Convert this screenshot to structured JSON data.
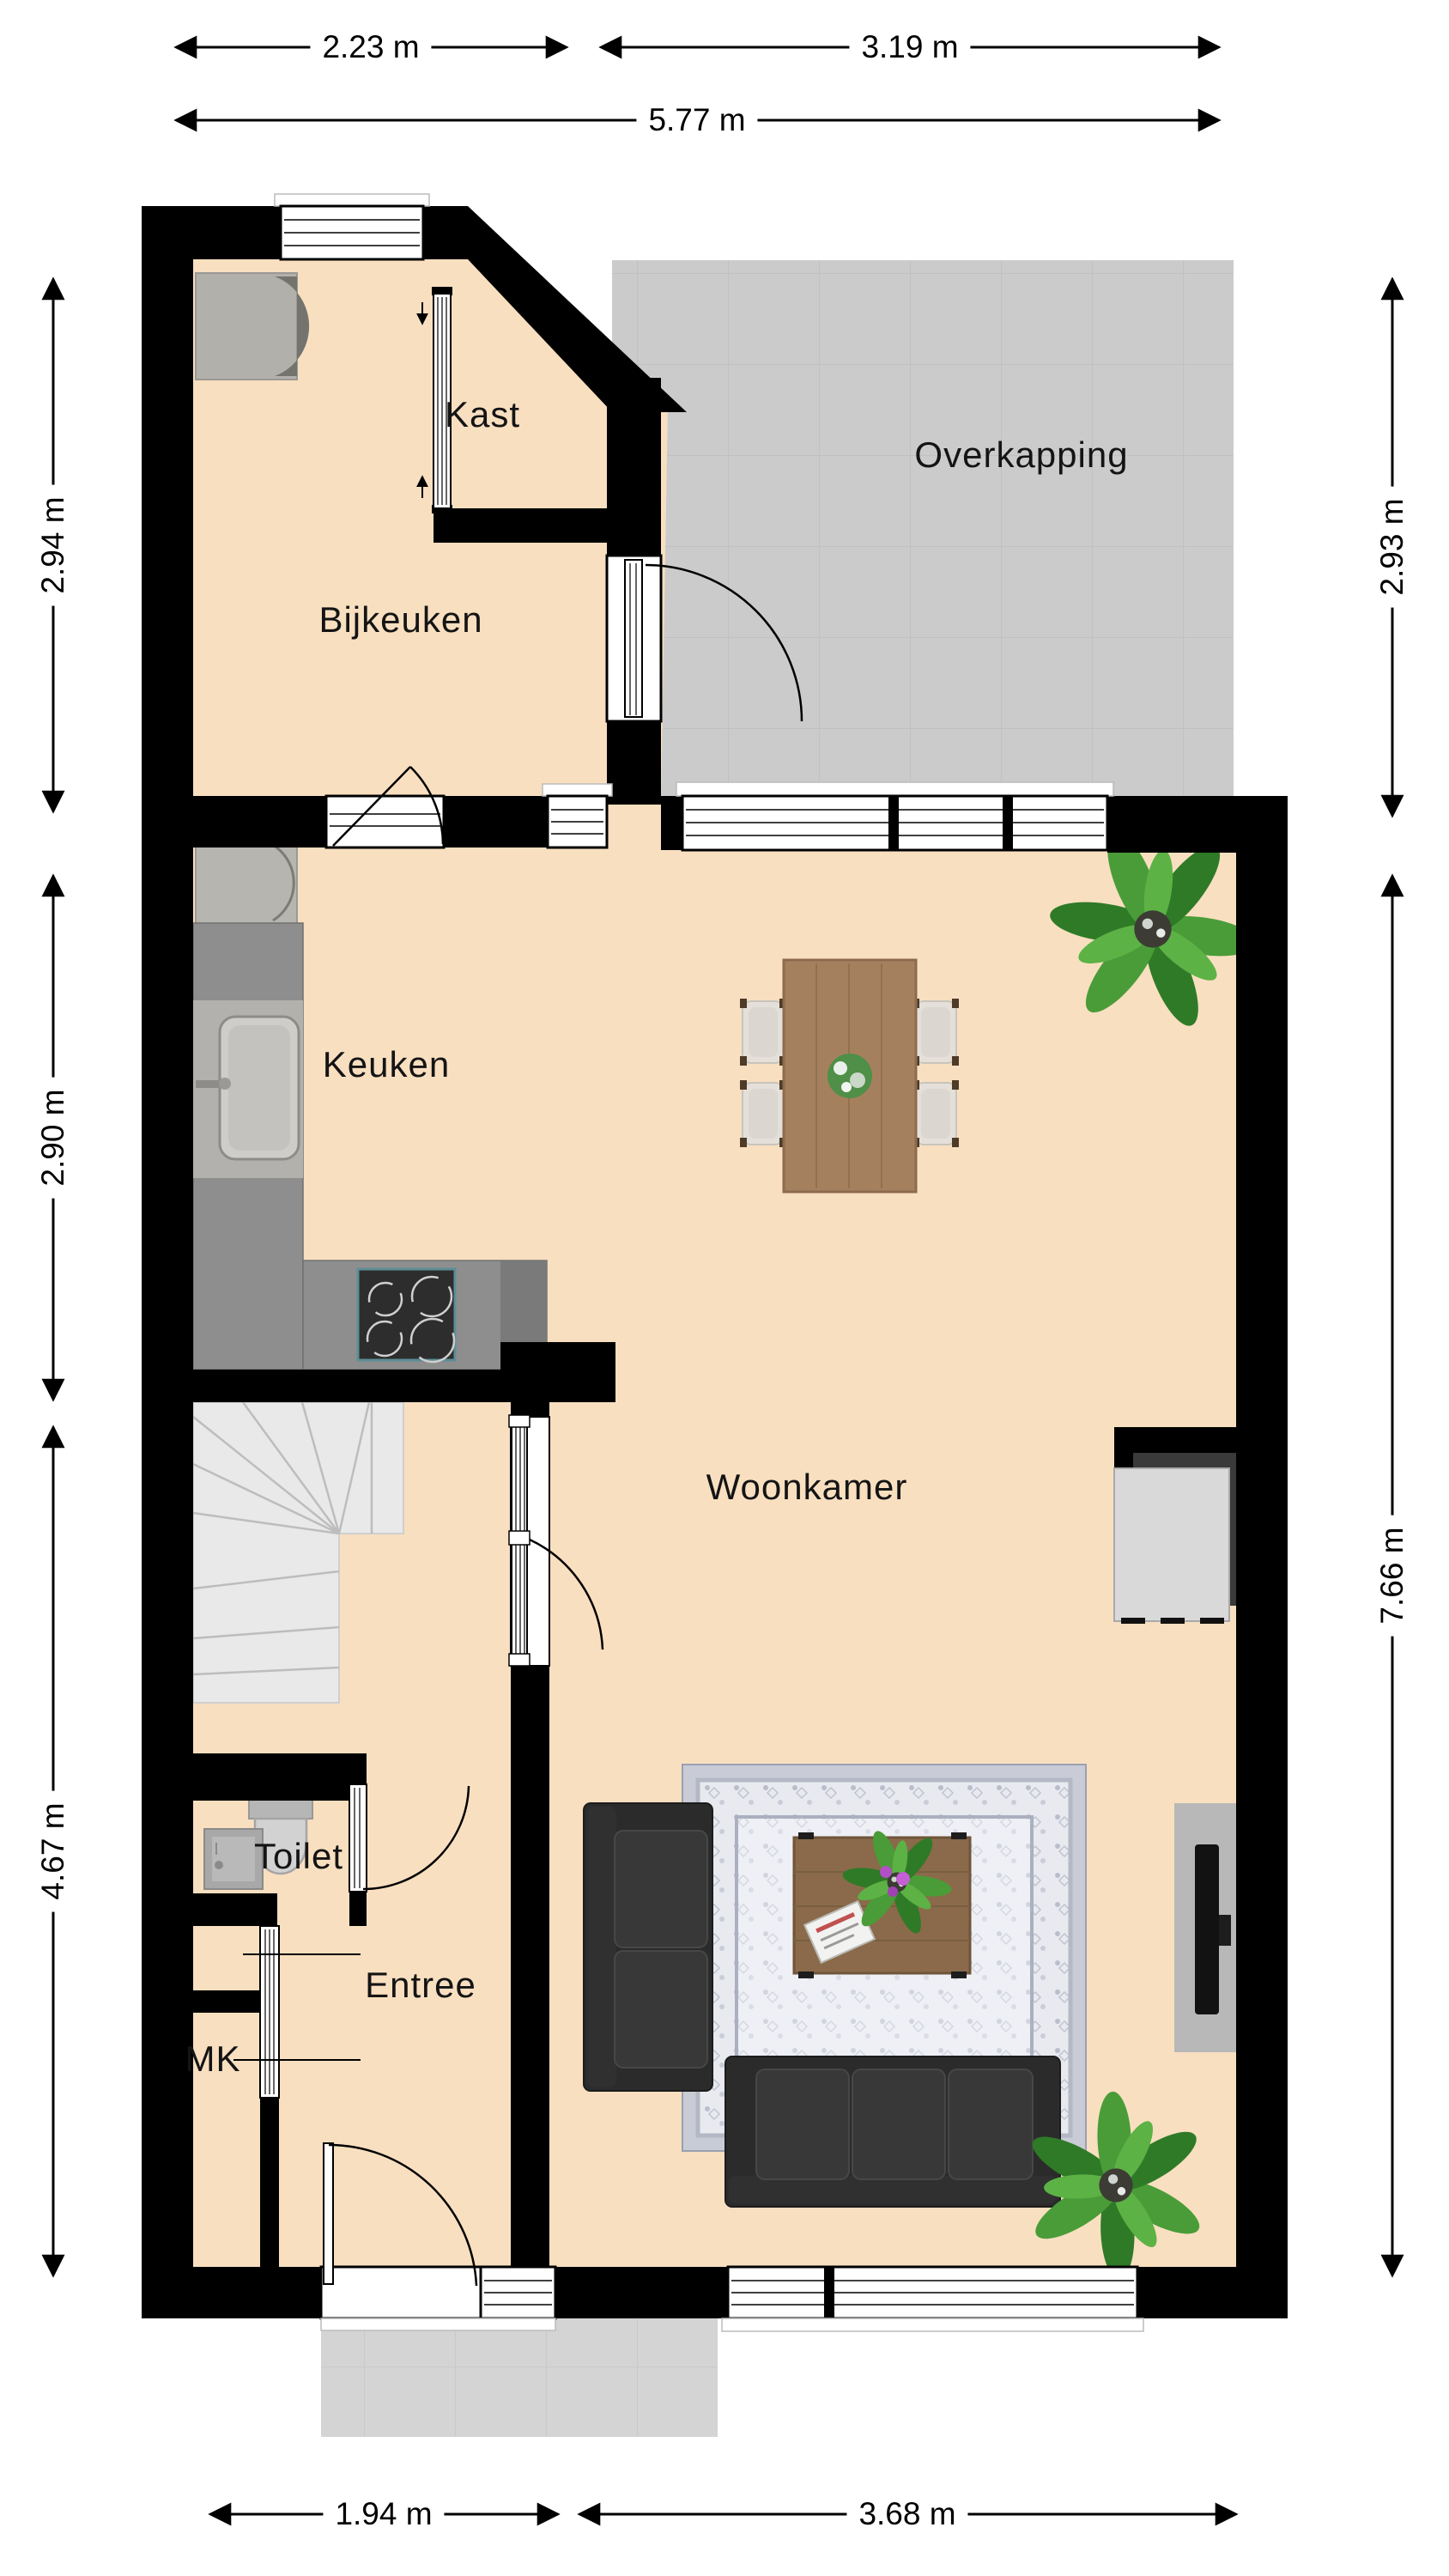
{
  "title": "Floor plan ground floor (begane grond)",
  "rooms": {
    "kast": {
      "label": "Kast"
    },
    "overkapping": {
      "label": "Overkapping"
    },
    "bijkeuken": {
      "label": "Bijkeuken"
    },
    "keuken": {
      "label": "Keuken"
    },
    "woonkamer": {
      "label": "Woonkamer"
    },
    "toilet": {
      "label": "Toilet"
    },
    "entree": {
      "label": "Entree"
    },
    "mk": {
      "label": "MK"
    }
  },
  "dimensions": {
    "top_left": "2.23 m",
    "top_right": "3.19 m",
    "top_total": "5.77 m",
    "left_upper": "2.94 m",
    "left_middle": "2.90 m",
    "left_lower": "4.67 m",
    "right_upper": "2.93 m",
    "right_lower": "7.66 m",
    "bottom_left": "1.94 m",
    "bottom_right": "3.68 m"
  },
  "colors": {
    "wall": "#000000",
    "floor": "#f8dfc0",
    "outdoor": "#cbcbcb",
    "stoop": "#d4d4d4",
    "counter": "#8e8e8e",
    "stairs": "#e9e9e9",
    "sofa": "#2b2b2b",
    "sofa_cushion": "#383838",
    "wood": "#a5805f",
    "wood_dark": "#8a6a4a",
    "cabinet": "#d9d9d9",
    "rug_field": "#e8eaf0",
    "rug_border": "#c9ccd6",
    "stove": "#2d2d2d",
    "stove_trim": "#5d8d95",
    "plant_green": "#4a9c38",
    "plant_green_dark": "#2f7a27"
  }
}
